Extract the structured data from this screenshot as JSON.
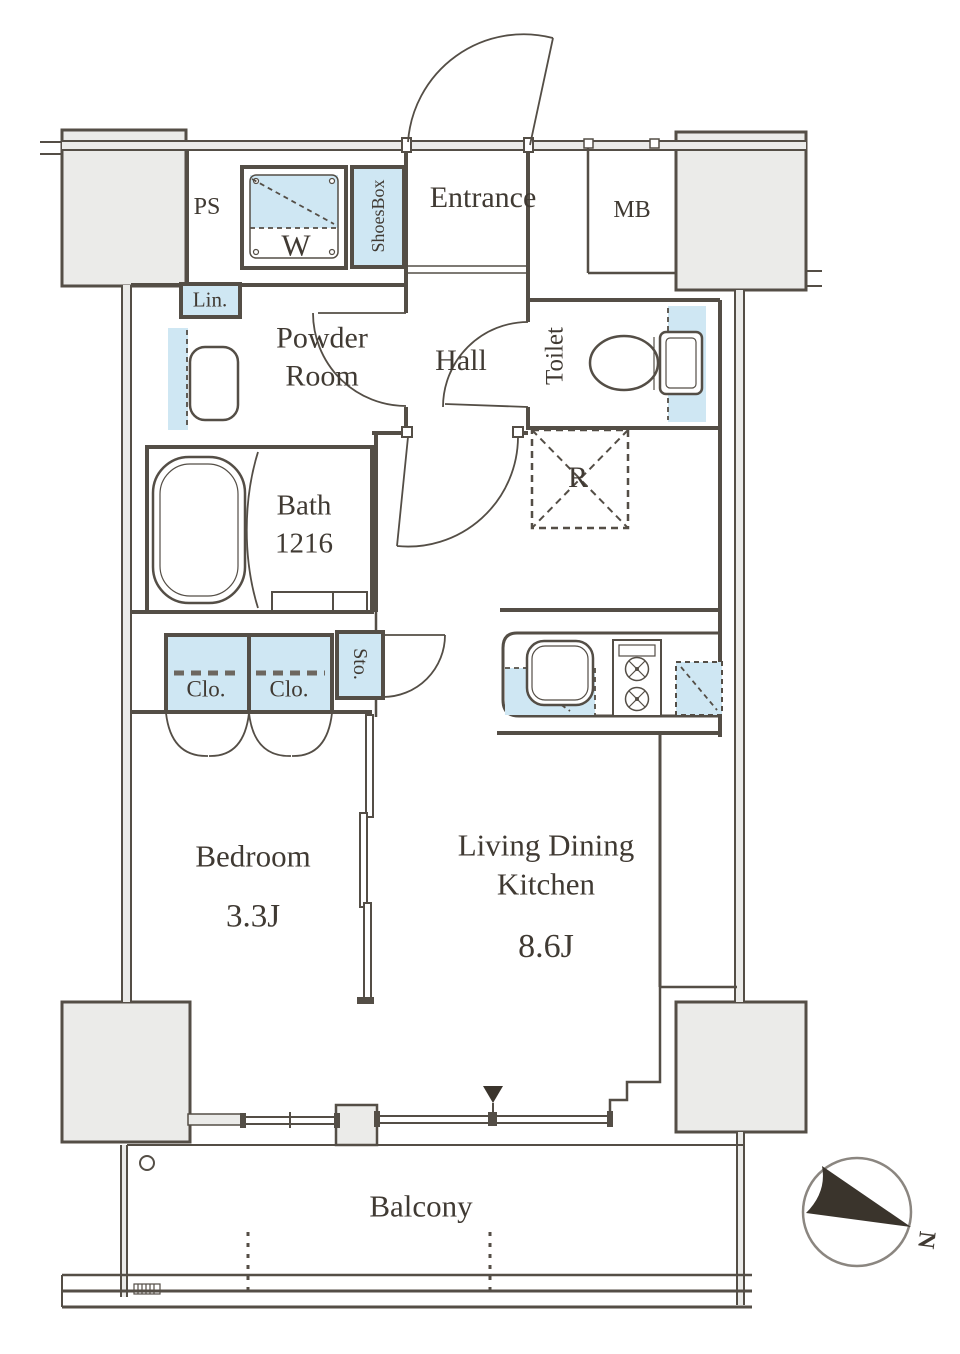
{
  "plan": {
    "rooms": {
      "entrance": "Entrance",
      "hall": "Hall",
      "powder_room_line1": "Powder",
      "powder_room_line2": "Room",
      "toilet": "Toilet",
      "bath": "Bath",
      "bath_size": "1216",
      "bedroom": "Bedroom",
      "bedroom_size": "3.3J",
      "ldk_line1": "Living Dining",
      "ldk_line2": "Kitchen",
      "ldk_size": "8.6J",
      "balcony": "Balcony"
    },
    "fixtures": {
      "pipe_space": "PS",
      "meter_box": "MB",
      "washing_machine": "W",
      "shoes_box": "ShoesBox",
      "linen": "Lin.",
      "refrigerator": "R",
      "closet1": "Clo.",
      "closet2": "Clo.",
      "storage": "Sto."
    },
    "compass": {
      "north": "N"
    },
    "colors": {
      "wall": "#544e46",
      "line": "#6b655d",
      "fixture-fill": "#cfe7f3",
      "column-fill": "#ebebe9",
      "text": "#403a33",
      "marker": "#3a342c"
    }
  }
}
